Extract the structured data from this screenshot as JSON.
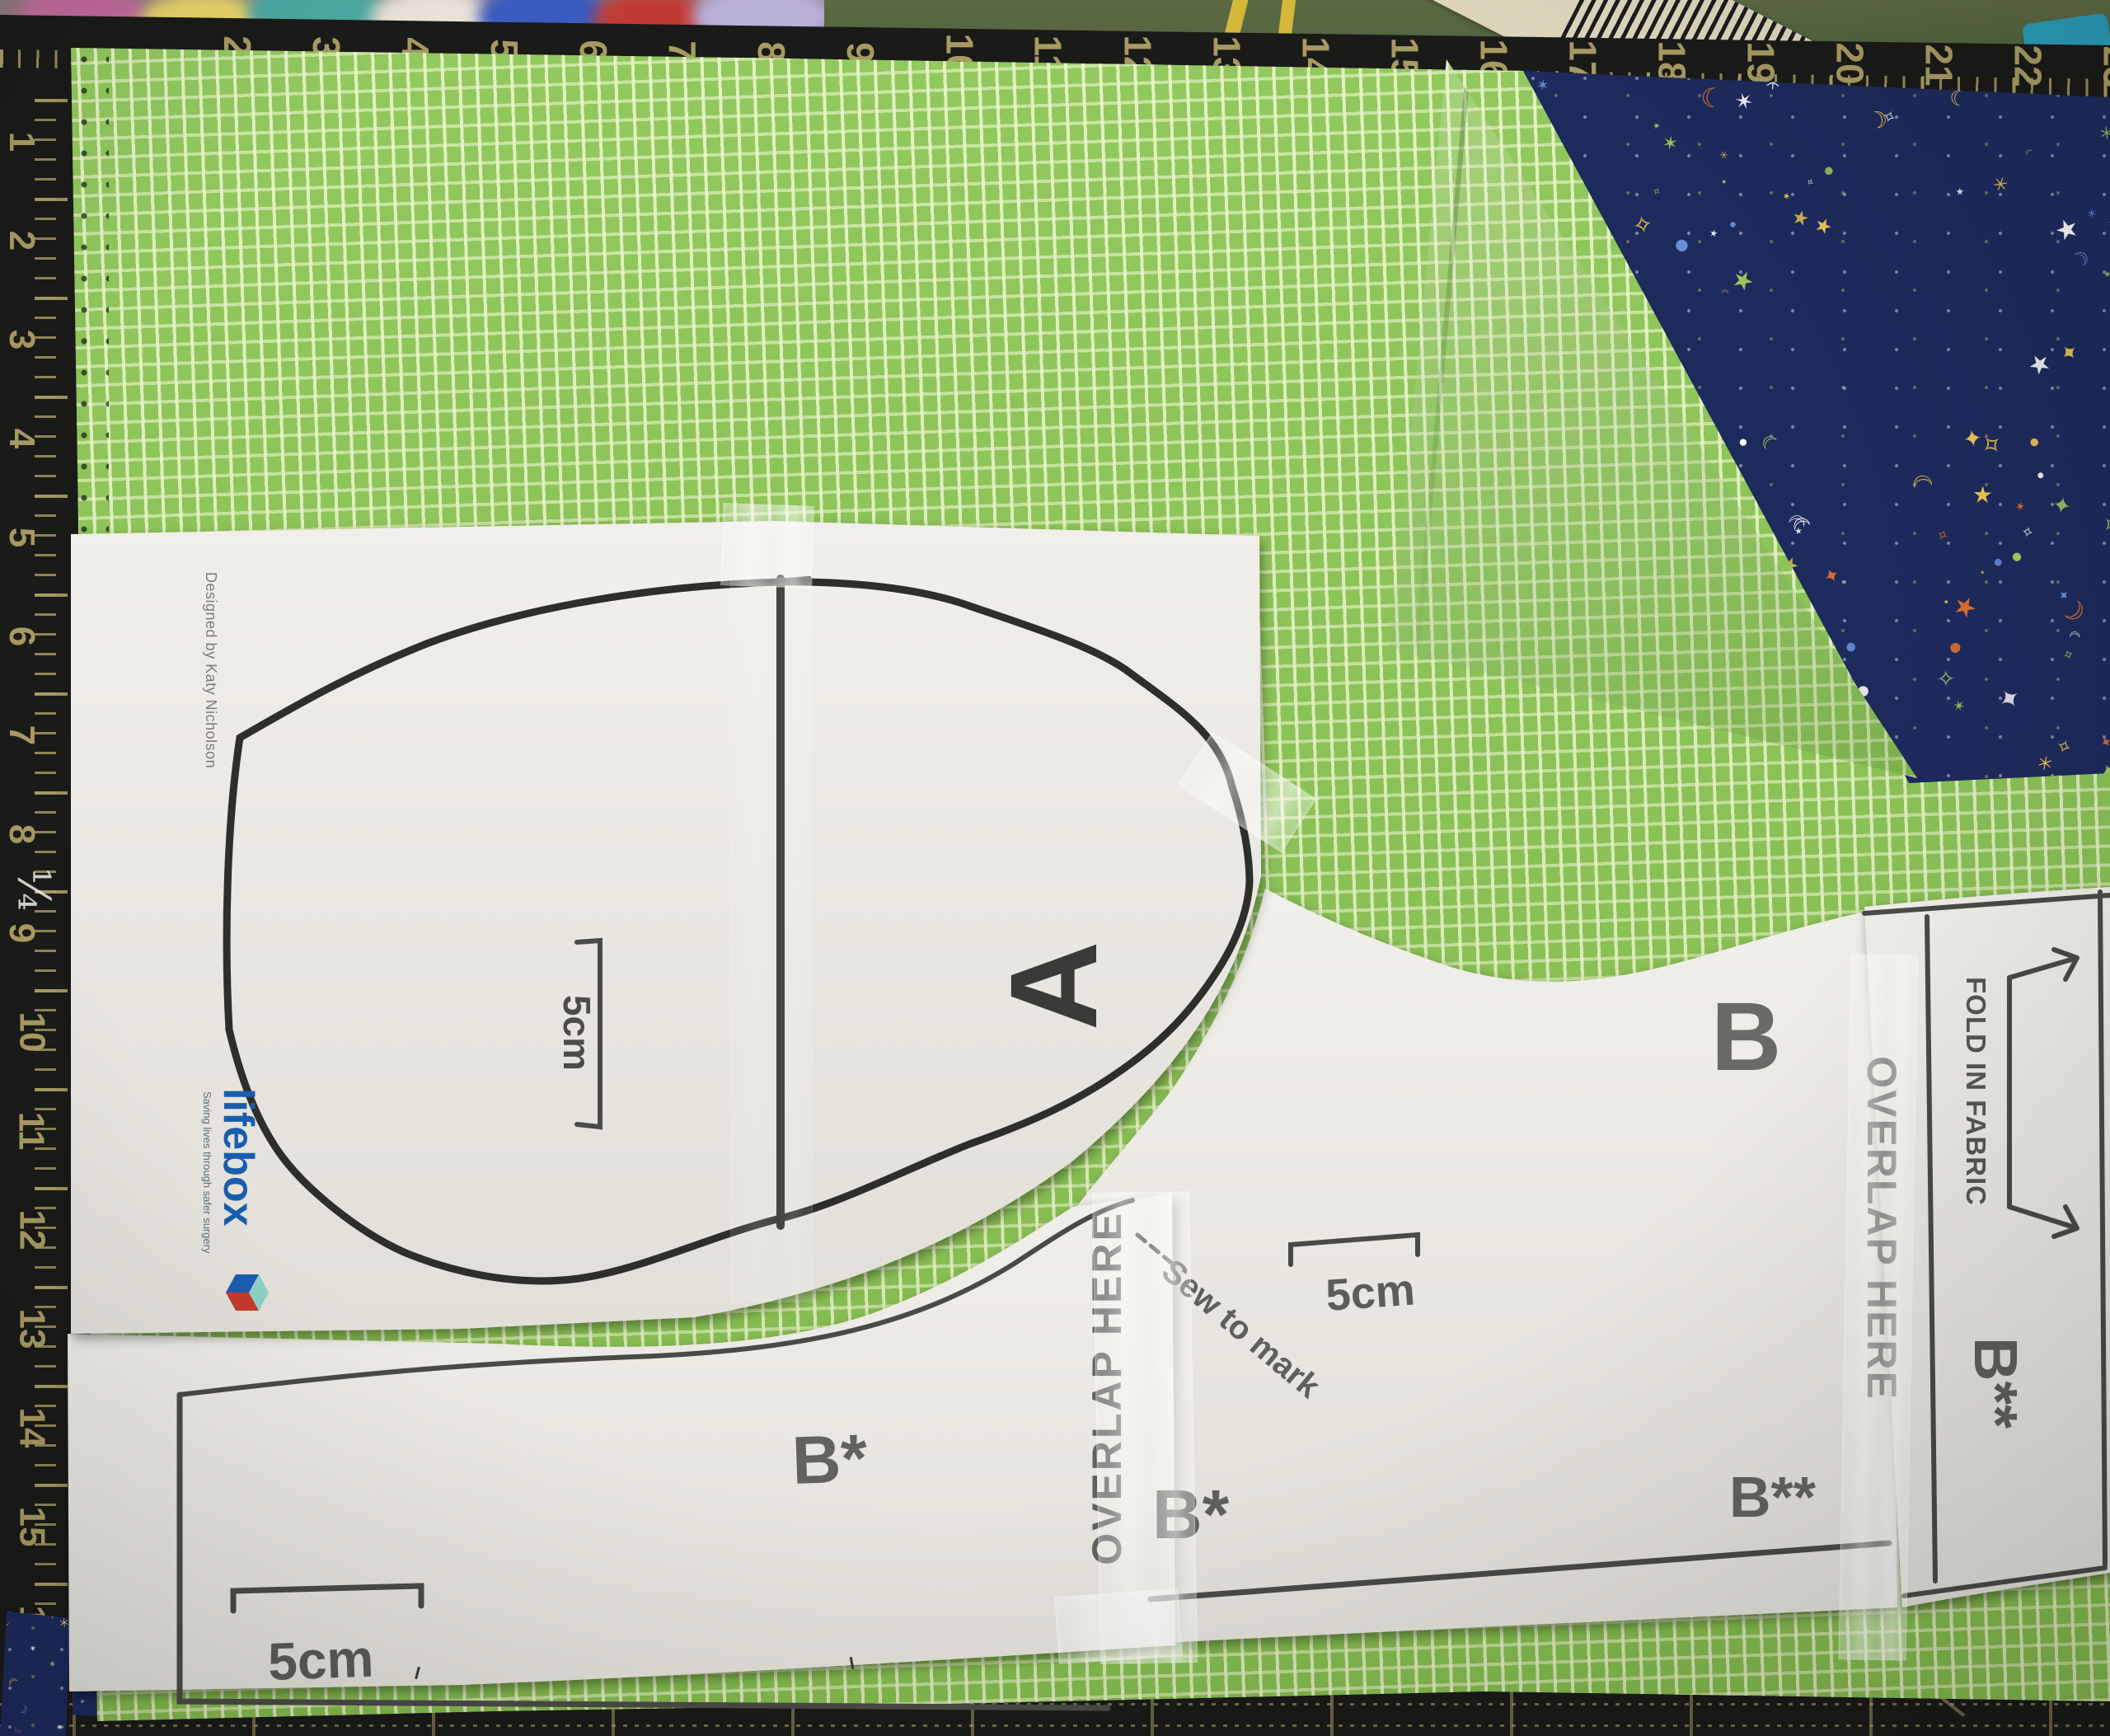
{
  "mat": {
    "top_ruler_numbers": [
      "2",
      "3",
      "4",
      "5",
      "6",
      "7",
      "8",
      "9",
      "10",
      "11",
      "12",
      "13",
      "14",
      "15",
      "16",
      "17",
      "18",
      "19",
      "20",
      "21",
      "22",
      "23"
    ],
    "left_ruler_numbers": [
      "1",
      "2",
      "3",
      "4",
      "5",
      "6",
      "7",
      "8",
      "9",
      "10",
      "11",
      "12",
      "13",
      "14",
      "15",
      "16",
      "17"
    ],
    "handwritten_mark": "¼"
  },
  "piece_a": {
    "label": "A",
    "scale_label": "5cm",
    "credit": "Designed by Katy Nicholson",
    "logo_text": "lifebox",
    "logo_tagline": "Saving lives through safer surgery"
  },
  "piece_b": {
    "label": "B",
    "scale_label": "5cm",
    "note": "Sew to mark",
    "overlap_label": "OVERLAP HERE",
    "label_b_star": "B*",
    "label_b_double_star": "B**"
  },
  "piece_b_star": {
    "label": "B*",
    "scale_label": "5cm"
  },
  "fold_strip": {
    "fold_label": "FOLD IN FABRIC",
    "overlap_label": "OVERLAP HERE",
    "label": "B**"
  },
  "star_fabric_motifs": [
    "★",
    "✦",
    "✶",
    "✧",
    "☾",
    "●",
    "＊"
  ],
  "colors": {
    "green_fabric": "#8bc453",
    "star_fabric_navy": "#1d2a5c",
    "mat_black": "#1a1a18",
    "mat_ruler": "#a79a62",
    "paper": "#eceae5",
    "print_gray": "#606060",
    "print_black": "#2e2e2b",
    "lifebox_blue": "#1a5dad",
    "lifebox_tagline": "#5e6e7e",
    "barcode_tan": "#ddd6bd",
    "table_olive": "#5d6b44",
    "cord_yellow": "#d4b83a",
    "teal_item": "#2a9cb8",
    "star_yellow": "#f2cd52",
    "star_orange": "#e8732f",
    "star_blue": "#6b93dd",
    "star_green": "#aed161"
  }
}
